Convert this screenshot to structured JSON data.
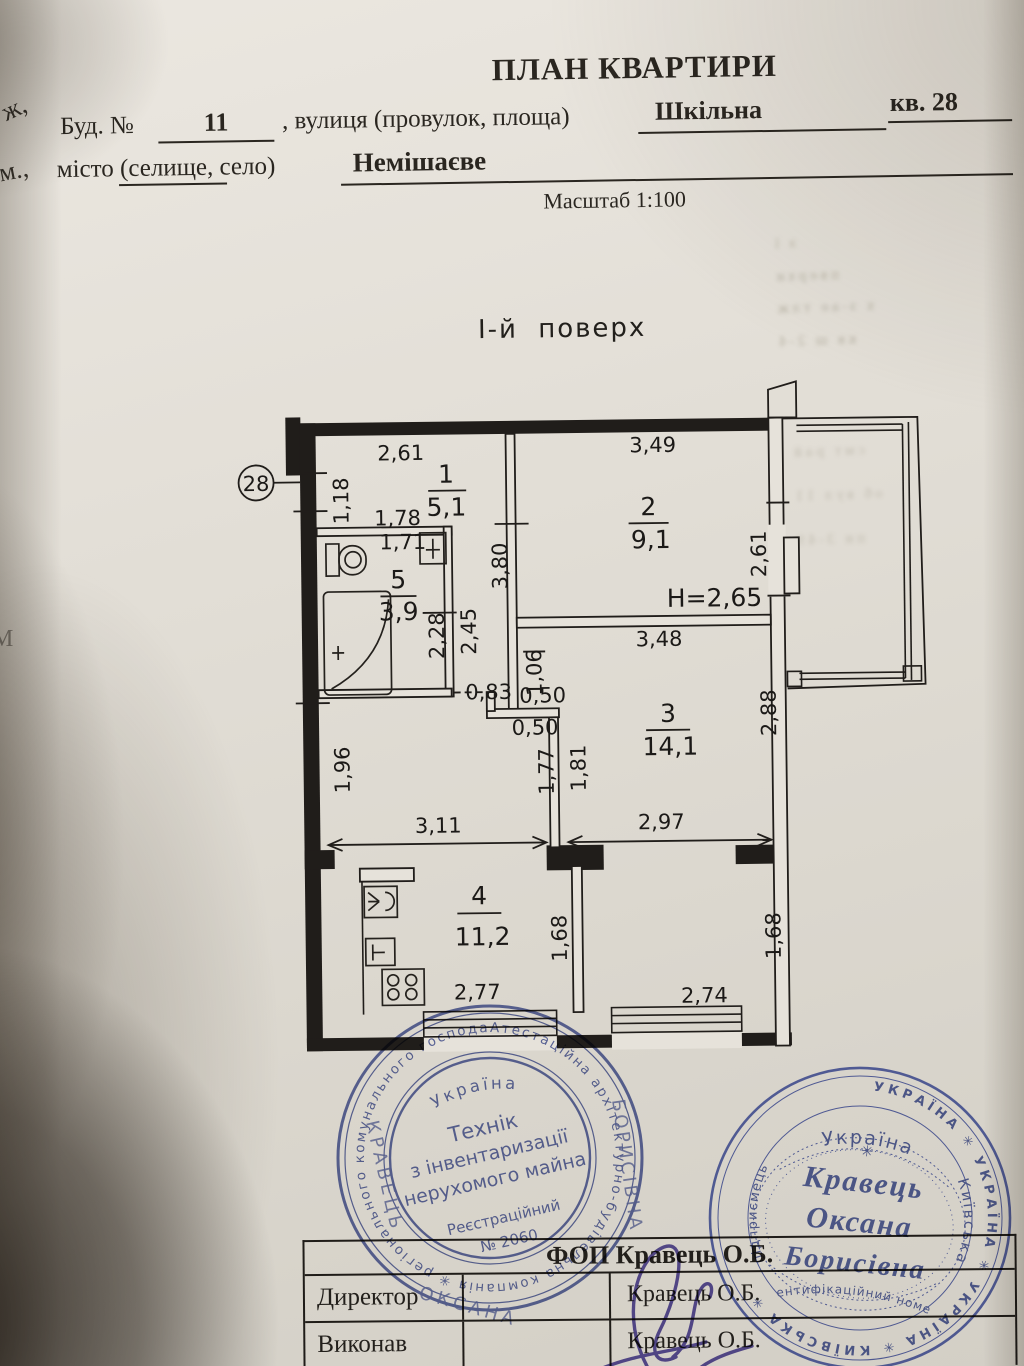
{
  "header": {
    "title": "ПЛАН КВАРТИРИ",
    "edge_fragment_1": "ж,",
    "edge_fragment_2": "м.,",
    "edge_fragment_3": "М",
    "label_building": "Буд. №",
    "building_value": "11",
    "label_street": ", вулиця (провулок, площа)",
    "street_value": "Шкільна",
    "apartment_value": "кв. 28",
    "label_city": "місто (селище, село)",
    "city_value": "Немішаєве",
    "scale": "Масштаб 1:100"
  },
  "plan": {
    "floor_title": "І-й  поверх",
    "callout": "28",
    "height_note": "H=2,65",
    "rooms": {
      "r1": {
        "num": "1",
        "area": "5,1"
      },
      "r2": {
        "num": "2",
        "area": "9,1"
      },
      "r3": {
        "num": "3",
        "area": "14,1"
      },
      "r4": {
        "num": "4",
        "area": "11,2"
      },
      "r5": {
        "num": "5",
        "area": "3,9"
      }
    },
    "dims": {
      "d261top": "2,61",
      "d349": "3,49",
      "d118": "1,18",
      "d178": "1,78",
      "d171": "1,71",
      "d380": "3,80",
      "d261r": "2,61",
      "d228": "2,28",
      "d245": "2,45",
      "d348": "3,48",
      "d106": "1,06",
      "d083": "0,83",
      "d050a": "0,50",
      "d050b": "0,50",
      "d288": "2,88",
      "d196": "1,96",
      "d177": "1,77",
      "d181": "1,81",
      "d311": "3,11",
      "d297": "2,97",
      "d168m": "1,68",
      "d168r": "1,68",
      "d277": "2,77",
      "d274": "2,74"
    }
  },
  "stamps": {
    "left": {
      "ring_text": "Атестаційна архітектурно-будівельна компанія ✳ регіонального комунального господарства ✳ № 166 ✳",
      "country": "Україна",
      "line1": "Технік",
      "line2": "з інвентаризації",
      "line3": "нерухомого майна",
      "line4": "Реєстраційний",
      "line5": "№ 2060",
      "overlay1": "КРАВЕЦЬ",
      "overlay2": "ОКСАНА",
      "overlay3": "БОРИСІВНА"
    },
    "right": {
      "ring_text": "УКРАЇНА ✳ УКРАЇНА ✳ УКРАЇНА ✳ КИЇВСЬКА ✳",
      "country": "Україна",
      "region": "Київська",
      "left_arc": "підприємець",
      "star": "✳",
      "name1": "Кравець",
      "name2": "Оксана",
      "name3": "Борисівна",
      "id_label": "ідентифікаційний номер"
    }
  },
  "table": {
    "header": "ФОП Кравець О.Б.",
    "rows": [
      {
        "label": "Директор",
        "value": "Кравець О.Б."
      },
      {
        "label": "Виконав",
        "value": "Кравець О.Б."
      }
    ]
  },
  "artifacts": {
    "bleed": [
      "з ї",
      "пверхи",
      "х з-ае тлж",
      "кв ш 2-4",
      "смт рай",
      "об вул 11",
      "пн 3-49"
    ]
  },
  "colors": {
    "stamp_blue": "#47569f",
    "signature_ink": "#4a3d9c",
    "paper": "#e2ded6"
  }
}
